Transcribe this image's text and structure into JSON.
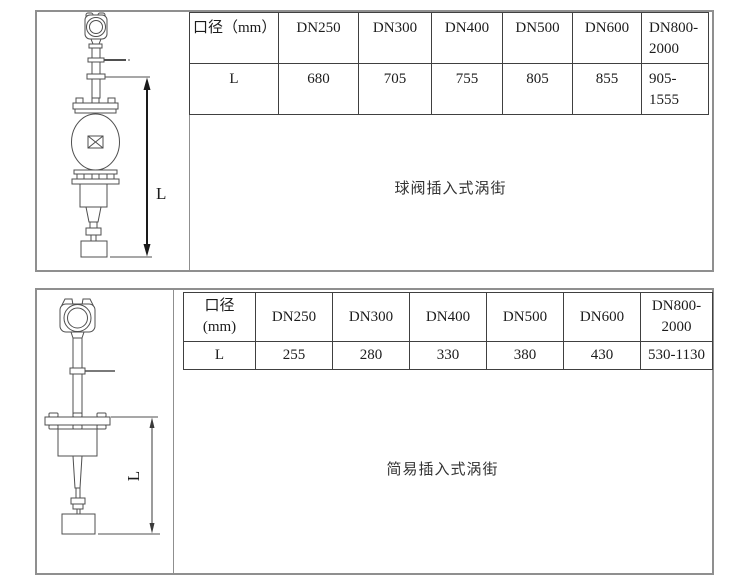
{
  "document": {
    "background": "#ffffff",
    "section_border_color": "#8f8f8f",
    "table_border_color": "#404040"
  },
  "sections": [
    {
      "id": "ball-valve-insertion",
      "caption": "球阀插入式涡街",
      "dimension_label": "L",
      "table": {
        "columns": [
          "口径（mm）",
          "DN250",
          "DN300",
          "DN400",
          "DN500",
          "DN600",
          "DN800-\n2000"
        ],
        "rows": [
          {
            "label": "L",
            "values": [
              "680",
              "705",
              "755",
              "805",
              "855",
              "905-\n1555"
            ]
          }
        ]
      }
    },
    {
      "id": "simple-insertion",
      "caption": "简易插入式涡街",
      "dimension_label": "L",
      "table": {
        "columns": [
          "口径\n(mm)",
          "DN250",
          "DN300",
          "DN400",
          "DN500",
          "DN600",
          "DN800-\n2000"
        ],
        "rows": [
          {
            "label": "L",
            "values": [
              "255",
              "280",
              "330",
              "380",
              "430",
              "530-1130"
            ]
          }
        ]
      }
    }
  ]
}
